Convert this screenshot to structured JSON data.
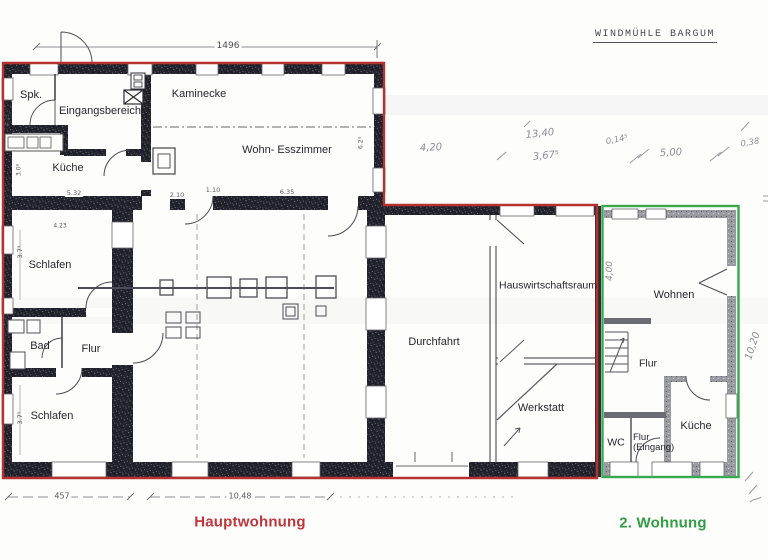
{
  "title": "WINDMÜHLE BARGUM",
  "apartments": {
    "main": {
      "name": "Hauptwohnung",
      "label_color": "#c0353b",
      "outline_color": "#b5322e"
    },
    "second": {
      "name": "2. Wohnung",
      "label_color": "#2f9e45",
      "outline_color": "#3aa84e"
    }
  },
  "rooms": {
    "spk": "Spk.",
    "eingangsbereich": "Eingangsbereich",
    "kaminecke": "Kaminecke",
    "kueche_haupt": "Küche",
    "wohn_esszimmer": "Wohn- Esszimmer",
    "schlafen_1": "Schlafen",
    "bad": "Bad",
    "flur_haupt": "Flur",
    "schlafen_2": "Schlafen",
    "durchfahrt": "Durchfahrt",
    "hauswirtschaftsraum": "Hauswirtschaftsraum",
    "werkstatt": "Werkstatt",
    "wohnen": "Wohnen",
    "flur_2": "Flur",
    "wc": "WC",
    "flur_eingang_line1": "Flur",
    "flur_eingang_line2": "(Eingang)",
    "kueche_2": "Küche"
  },
  "dimensions": {
    "printed": {
      "total_width": "1496",
      "bottom_left": "457",
      "bottom_main": "10,48",
      "d_532": "5.32",
      "d_210": "2.10",
      "d_110": "1.10",
      "d_635": "6.35",
      "d_423": "4.23",
      "v_375_a": "3.7⁵",
      "v_375_b": "3.7⁵",
      "v_411": "4.11",
      "v_308": "3.0⁸",
      "v_620": "6.2⁰"
    },
    "handwritten": {
      "h_420": "4,20",
      "h_1340": "13,40",
      "h_3675": "3,67⁵",
      "h_0145": "0,14⁵",
      "h_500": "5,00",
      "h_038": "0,38",
      "v_400": "4,00",
      "v_1020": "10,20"
    }
  },
  "colors": {
    "wall_dark": "#22222b",
    "wall_gray": "#9a9aa1",
    "pencil": "#8d8d95",
    "paper": "#fdfdfc"
  }
}
